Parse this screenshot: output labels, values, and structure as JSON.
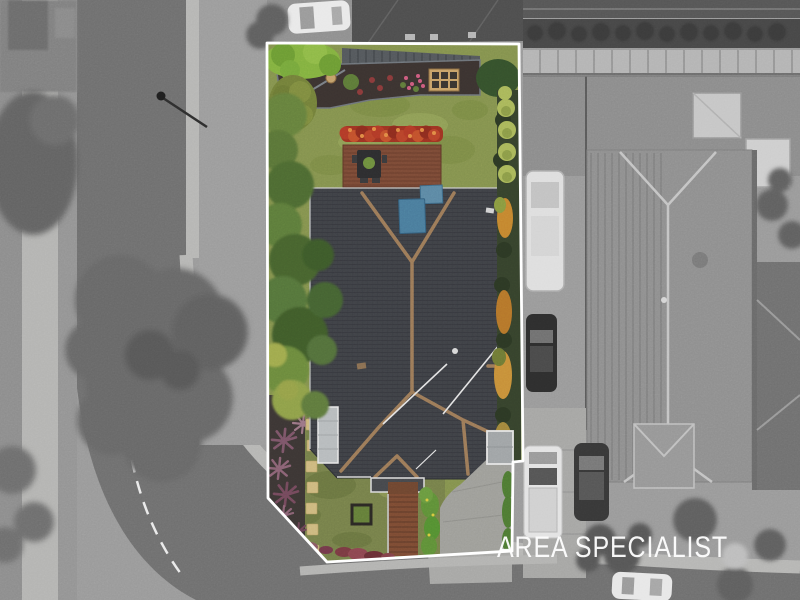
{
  "watermark": {
    "text": "AREA SPECIALIST"
  },
  "scene": {
    "kind": "aerial drone photo of a property listing",
    "highlight": "colored lot outlined in white over grayscale surroundings",
    "stepping_stones": 7,
    "topiary_balls": 5
  },
  "palette": {
    "boundary": "#ffffff",
    "watermark": "#ffffff",
    "surround_base": "#9a9a9a",
    "road_asphalt": "#6f6f6f",
    "footpath": "#b6b6b4",
    "lawn_back": "#84924e",
    "lawn_front": "#76804a",
    "roof_tiles": "#3f4146",
    "roof_ridge": "#9c7a58",
    "deck_wood": "#7b4a36",
    "flower_hedge_red": "#9e3322",
    "solar_panel_blue": "#4a7c9c",
    "driveway_concrete": "#9e9e99",
    "walkway_wood": "#7c4b33",
    "mulch": "#3c3634",
    "hedge_dark": "#36422c",
    "topiary_green": "#a9b75a",
    "neighbor_roof": "#8f8f8f"
  }
}
